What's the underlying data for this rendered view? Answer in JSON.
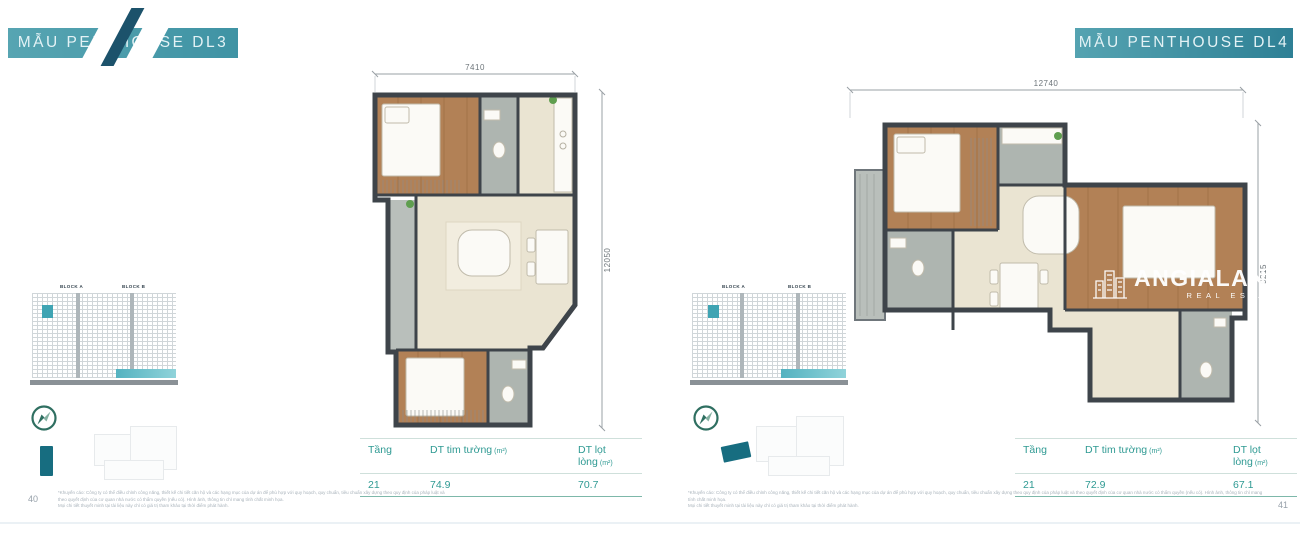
{
  "elevation": {
    "block_a": "BLOCK A",
    "block_b": "BLOCK B"
  },
  "left_page": {
    "banner": "MẪU PENTHOUSE DL3",
    "dims": {
      "top": "7410",
      "side": "12050"
    },
    "table": {
      "floor_label": "Tầng",
      "gross_label": "DT tim tường",
      "gross_unit": "(m²)",
      "net_label": "DT lọt lòng",
      "net_unit": "(m²)",
      "floor": "21",
      "gross": "74.9",
      "net": "70.7"
    },
    "page_number": "40"
  },
  "right_page": {
    "banner": "MẪU PENTHOUSE DL4",
    "dims": {
      "top": "12740",
      "side": "9215"
    },
    "table": {
      "floor_label": "Tầng",
      "gross_label": "DT tim tường",
      "gross_unit": "(m²)",
      "net_label": "DT lọt lòng",
      "net_unit": "(m²)",
      "floor": "21",
      "gross": "72.9",
      "net": "67.1"
    },
    "page_number": "41",
    "watermark": {
      "title": "ANGIALAND",
      "subtitle": "REAL ESTATE"
    }
  },
  "disclaimer": {
    "line1": "*Khuyến cáo: Công ty có thể điều chỉnh công năng, thiết kế chi tiết căn hộ và các hạng mục của dự án để phù hợp với quy hoạch, quy chuẩn, tiêu chuẩn xây dựng theo quy định của pháp luật và theo quyết định của cơ quan nhà nước có thẩm quyền (nếu có). Hình ảnh, thông tin chỉ mang tính chất minh họa.",
    "line2": "Mọi chi tiết thuyết minh tại tài liệu này chỉ có giá trị tham khảo tại thời điểm phát hành."
  },
  "colors": {
    "banner_teal": "#4599a9",
    "accent_teal": "#3fa4b3",
    "table_teal": "#2f9a93",
    "wall": "#3e444a",
    "wood_floor": "#b28156",
    "floor_beige": "#eae4d2",
    "tile_gray": "#aeb5b0",
    "highlight_unit": "#176d80"
  }
}
